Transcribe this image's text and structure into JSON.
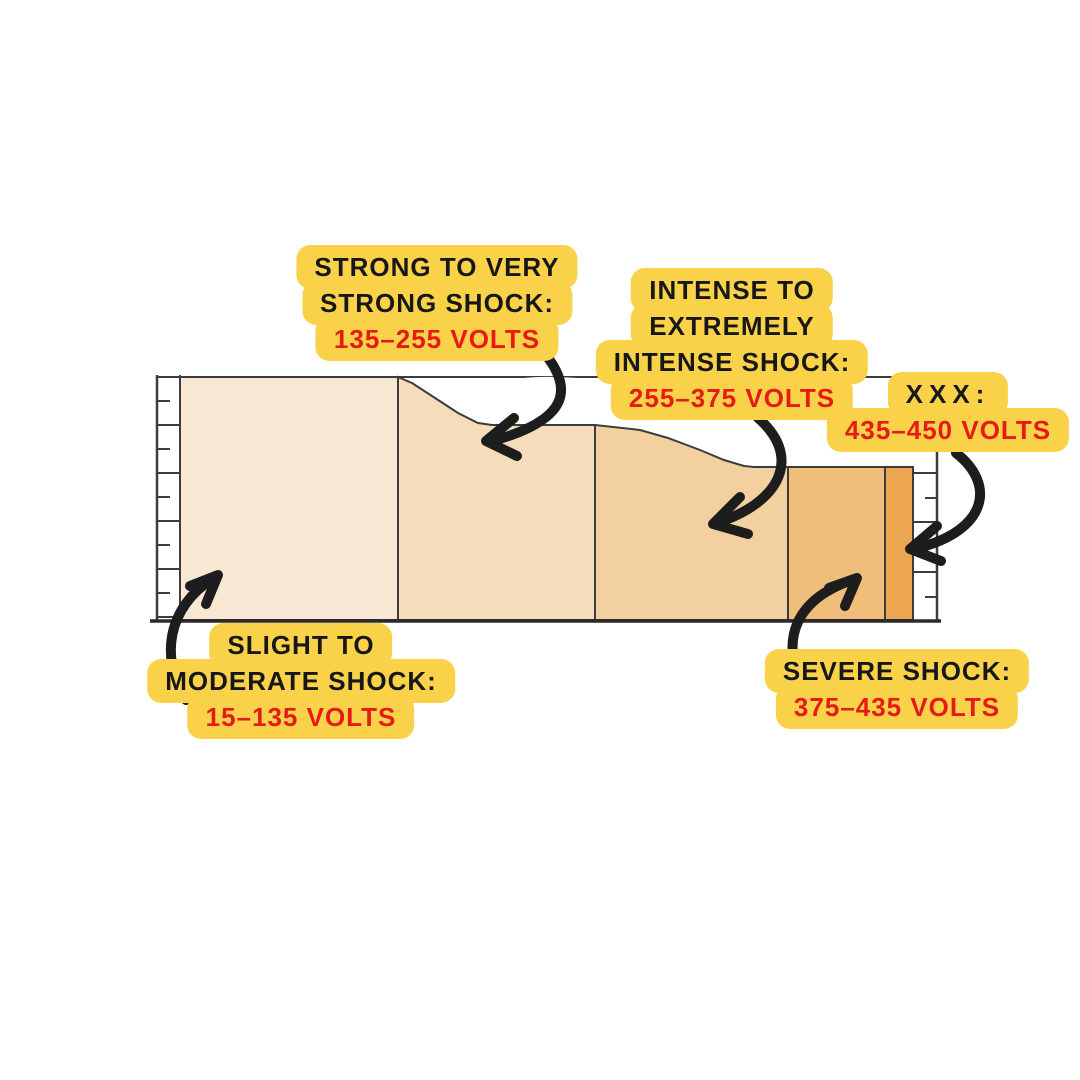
{
  "colors": {
    "background": "#FFFFFF",
    "label_bg": "#F9D24A",
    "label_text": "#171717",
    "volts_text": "#E41B17",
    "ink": "#1D1D1D",
    "frame": "#3C3C3C"
  },
  "segments": [
    {
      "name": "slight-to-moderate-shock",
      "range": "15–135 volts",
      "color": "#F8E7D2"
    },
    {
      "name": "strong-to-very-strong-shock",
      "range": "135–255 volts",
      "color": "#F6DCBA"
    },
    {
      "name": "intense-to-extremely-intense-shock",
      "range": "255–375 volts",
      "color": "#F3D0A0"
    },
    {
      "name": "severe-shock",
      "range": "375–435 volts",
      "color": "#F0BD7A"
    },
    {
      "name": "xxx",
      "range": "435–450 volts",
      "color": "#ECA550"
    }
  ],
  "callouts": {
    "strong": {
      "lines": [
        "STRONG TO VERY",
        "STRONG SHOCK:"
      ],
      "volts": "135–255 VOLTS"
    },
    "intense": {
      "lines": [
        "INTENSE TO",
        "EXTREMELY",
        "INTENSE SHOCK:"
      ],
      "volts": "255–375 VOLTS"
    },
    "xxx": {
      "lines": [
        "XXX:"
      ],
      "volts": "435–450 VOLTS"
    },
    "slight": {
      "lines": [
        "SLIGHT TO",
        "MODERATE SHOCK:"
      ],
      "volts": "15–135 VOLTS"
    },
    "severe": {
      "lines": [
        "SEVERE SHOCK:"
      ],
      "volts": "375–435 VOLTS"
    }
  }
}
